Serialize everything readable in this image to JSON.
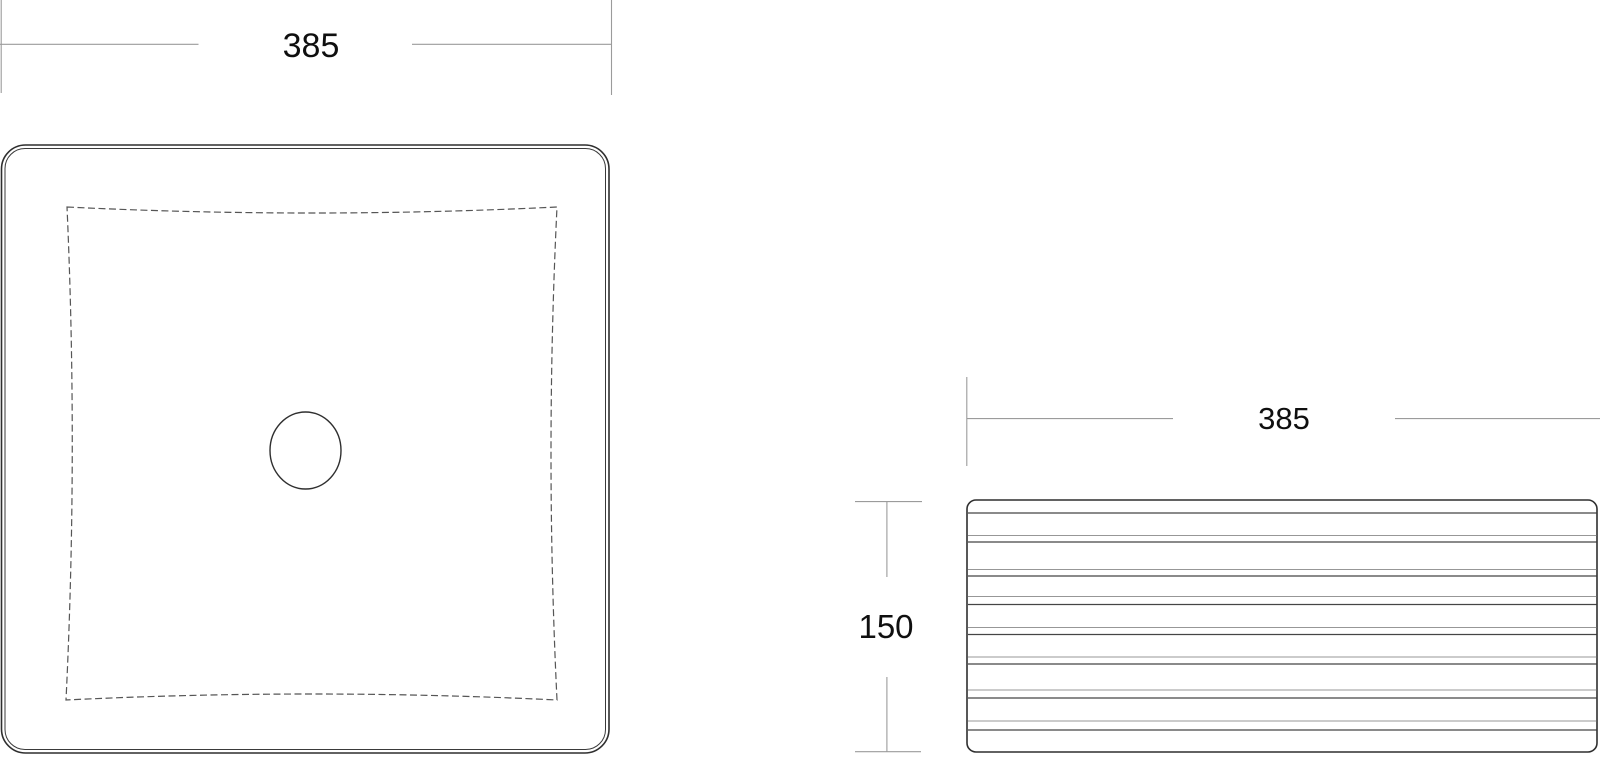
{
  "drawing": {
    "top_view": {
      "width_label": "385"
    },
    "side_view": {
      "width_label": "385",
      "height_label": "150"
    }
  },
  "colors": {
    "background": "#ffffff",
    "outline": "#2f2f2f",
    "dashed_edge": "#555555",
    "dimension_line": "#9b9b9b",
    "text": "#0f0f0f"
  }
}
